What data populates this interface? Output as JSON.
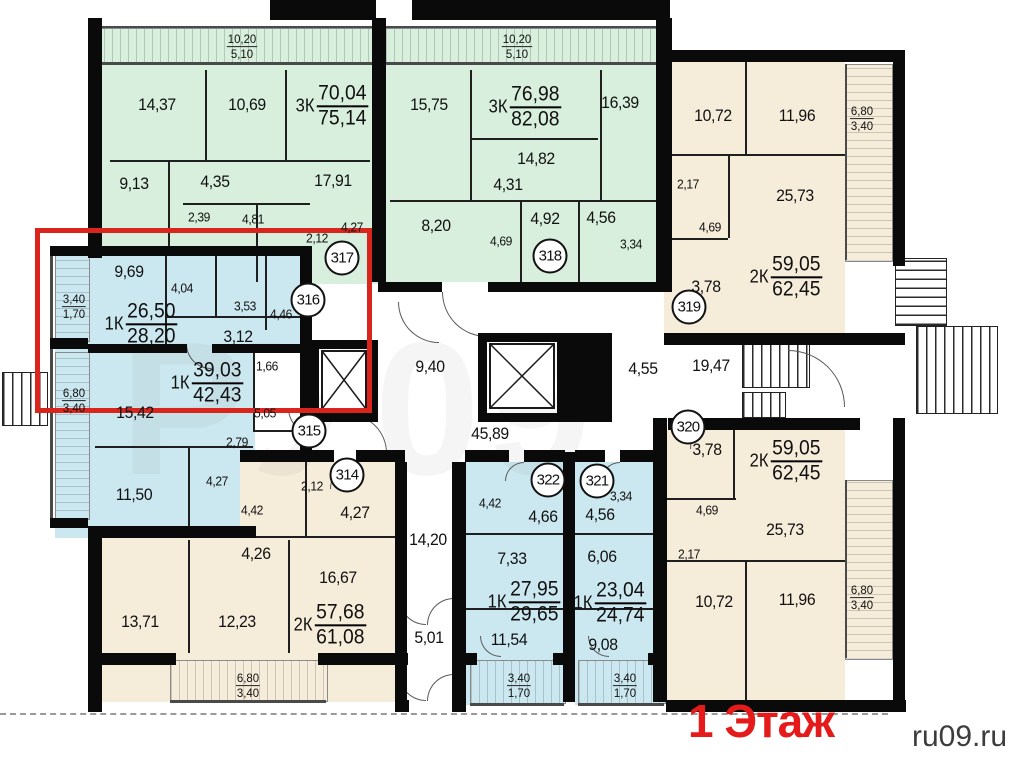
{
  "floor_label": "1 Этаж",
  "watermark": "ru09.ru",
  "colors": {
    "green": "#d7efdc",
    "blue": "#cbe8f0",
    "beige": "#f6ecda",
    "highlight": "#da251d",
    "floor_red": "#e51b1b",
    "wall": "#0a0a0a"
  },
  "room_labels": [
    {
      "t": "14,37",
      "x": 157,
      "y": 105
    },
    {
      "t": "10,69",
      "x": 247,
      "y": 105
    },
    {
      "t": "9,13",
      "x": 134,
      "y": 184
    },
    {
      "t": "4,35",
      "x": 215,
      "y": 182
    },
    {
      "t": "17,91",
      "x": 333,
      "y": 181
    },
    {
      "t": "2,39",
      "x": 199,
      "y": 217,
      "s": 1
    },
    {
      "t": "4,81",
      "x": 253,
      "y": 219,
      "s": 1
    },
    {
      "t": "2,12",
      "x": 317,
      "y": 238,
      "s": 1
    },
    {
      "t": "4,27",
      "x": 352,
      "y": 227,
      "s": 1
    },
    {
      "t": "15,75",
      "x": 429,
      "y": 105
    },
    {
      "t": "16,39",
      "x": 620,
      "y": 103
    },
    {
      "t": "14,82",
      "x": 536,
      "y": 159
    },
    {
      "t": "4,31",
      "x": 508,
      "y": 185
    },
    {
      "t": "8,20",
      "x": 436,
      "y": 226
    },
    {
      "t": "4,92",
      "x": 545,
      "y": 219
    },
    {
      "t": "4,56",
      "x": 601,
      "y": 218
    },
    {
      "t": "4,69",
      "x": 501,
      "y": 241,
      "s": 1
    },
    {
      "t": "3,34",
      "x": 631,
      "y": 244,
      "s": 1
    },
    {
      "t": "10,72",
      "x": 713,
      "y": 116
    },
    {
      "t": "11,96",
      "x": 797,
      "y": 116
    },
    {
      "t": "2,17",
      "x": 688,
      "y": 184,
      "s": 1
    },
    {
      "t": "25,73",
      "x": 795,
      "y": 196
    },
    {
      "t": "4,69",
      "x": 710,
      "y": 227,
      "s": 1
    },
    {
      "t": "3,78",
      "x": 706,
      "y": 287
    },
    {
      "t": "9,69",
      "x": 129,
      "y": 272
    },
    {
      "t": "4,04",
      "x": 182,
      "y": 288,
      "s": 1
    },
    {
      "t": "3,53",
      "x": 245,
      "y": 306,
      "s": 1
    },
    {
      "t": "4,46",
      "x": 281,
      "y": 314,
      "s": 1
    },
    {
      "t": "3,12",
      "x": 238,
      "y": 337
    },
    {
      "t": "15,42",
      "x": 135,
      "y": 413
    },
    {
      "t": "1,66",
      "x": 267,
      "y": 366,
      "s": 1
    },
    {
      "t": "5,05",
      "x": 265,
      "y": 413,
      "s": 1
    },
    {
      "t": "2,79",
      "x": 237,
      "y": 442,
      "s": 1
    },
    {
      "t": "11,50",
      "x": 134,
      "y": 495
    },
    {
      "t": "4,27",
      "x": 217,
      "y": 481,
      "s": 1
    },
    {
      "t": "2,12",
      "x": 312,
      "y": 486,
      "s": 1
    },
    {
      "t": "4,27",
      "x": 355,
      "y": 513
    },
    {
      "t": "4,42",
      "x": 252,
      "y": 510,
      "s": 1
    },
    {
      "t": "4,26",
      "x": 256,
      "y": 554
    },
    {
      "t": "16,67",
      "x": 338,
      "y": 578
    },
    {
      "t": "13,71",
      "x": 140,
      "y": 622
    },
    {
      "t": "12,23",
      "x": 237,
      "y": 622
    },
    {
      "t": "9,40",
      "x": 430,
      "y": 367
    },
    {
      "t": "45,89",
      "x": 490,
      "y": 434
    },
    {
      "t": "4,55",
      "x": 643,
      "y": 369
    },
    {
      "t": "19,47",
      "x": 711,
      "y": 366
    },
    {
      "t": "14,20",
      "x": 428,
      "y": 540
    },
    {
      "t": "5,01",
      "x": 429,
      "y": 638
    },
    {
      "t": "4,42",
      "x": 490,
      "y": 503,
      "s": 1
    },
    {
      "t": "4,66",
      "x": 543,
      "y": 517
    },
    {
      "t": "7,33",
      "x": 512,
      "y": 559
    },
    {
      "t": "11,54",
      "x": 509,
      "y": 640
    },
    {
      "t": "3,34",
      "x": 621,
      "y": 496,
      "s": 1
    },
    {
      "t": "4,56",
      "x": 600,
      "y": 515
    },
    {
      "t": "6,06",
      "x": 602,
      "y": 557
    },
    {
      "t": "9,08",
      "x": 603,
      "y": 645
    },
    {
      "t": "3,78",
      "x": 707,
      "y": 450
    },
    {
      "t": "4,69",
      "x": 707,
      "y": 510,
      "s": 1
    },
    {
      "t": "2,17",
      "x": 689,
      "y": 554,
      "s": 1
    },
    {
      "t": "25,73",
      "x": 785,
      "y": 530
    },
    {
      "t": "10,72",
      "x": 714,
      "y": 602
    },
    {
      "t": "11,96",
      "x": 797,
      "y": 600
    }
  ],
  "apartment_area_labels": [
    {
      "k": "3К",
      "a": "70,04",
      "b": "75,14",
      "x": 332,
      "y": 106
    },
    {
      "k": "3К",
      "a": "76,98",
      "b": "82,08",
      "x": 525,
      "y": 107
    },
    {
      "k": "2К",
      "a": "59,05",
      "b": "62,45",
      "x": 786,
      "y": 277
    },
    {
      "k": "1К",
      "a": "26,50",
      "b": "28,20",
      "x": 141,
      "y": 324
    },
    {
      "k": "1К",
      "a": "39,03",
      "b": "42,43",
      "x": 207,
      "y": 383
    },
    {
      "k": "2К",
      "a": "57,68",
      "b": "61,08",
      "x": 330,
      "y": 625
    },
    {
      "k": "1К",
      "a": "27,95",
      "b": "29,65",
      "x": 524,
      "y": 602
    },
    {
      "k": "1К",
      "a": "23,04",
      "b": "24,74",
      "x": 610,
      "y": 603
    },
    {
      "k": "2К",
      "a": "59,05",
      "b": "62,45",
      "x": 786,
      "y": 461
    }
  ],
  "dimension_labels": [
    {
      "a": "10,20",
      "b": "5,10",
      "x": 242,
      "y": 47
    },
    {
      "a": "10,20",
      "b": "5,10",
      "x": 517,
      "y": 47
    },
    {
      "a": "6,80",
      "b": "3,40",
      "x": 862,
      "y": 119
    },
    {
      "a": "3,40",
      "b": "1,70",
      "x": 74,
      "y": 307
    },
    {
      "a": "6,80",
      "b": "3,40",
      "x": 74,
      "y": 401
    },
    {
      "a": "6,80",
      "b": "3,40",
      "x": 248,
      "y": 686
    },
    {
      "a": "3,40",
      "b": "1,70",
      "x": 519,
      "y": 686
    },
    {
      "a": "3,40",
      "b": "1,70",
      "x": 625,
      "y": 686
    },
    {
      "a": "6,80",
      "b": "3,40",
      "x": 862,
      "y": 598
    }
  ],
  "apartment_numbers": [
    {
      "n": "317",
      "x": 342,
      "y": 258
    },
    {
      "n": "318",
      "x": 550,
      "y": 256
    },
    {
      "n": "319",
      "x": 689,
      "y": 307
    },
    {
      "n": "316",
      "x": 308,
      "y": 300
    },
    {
      "n": "315",
      "x": 309,
      "y": 431
    },
    {
      "n": "314",
      "x": 347,
      "y": 475
    },
    {
      "n": "322",
      "x": 548,
      "y": 480
    },
    {
      "n": "321",
      "x": 597,
      "y": 481
    },
    {
      "n": "320",
      "x": 688,
      "y": 427
    }
  ]
}
